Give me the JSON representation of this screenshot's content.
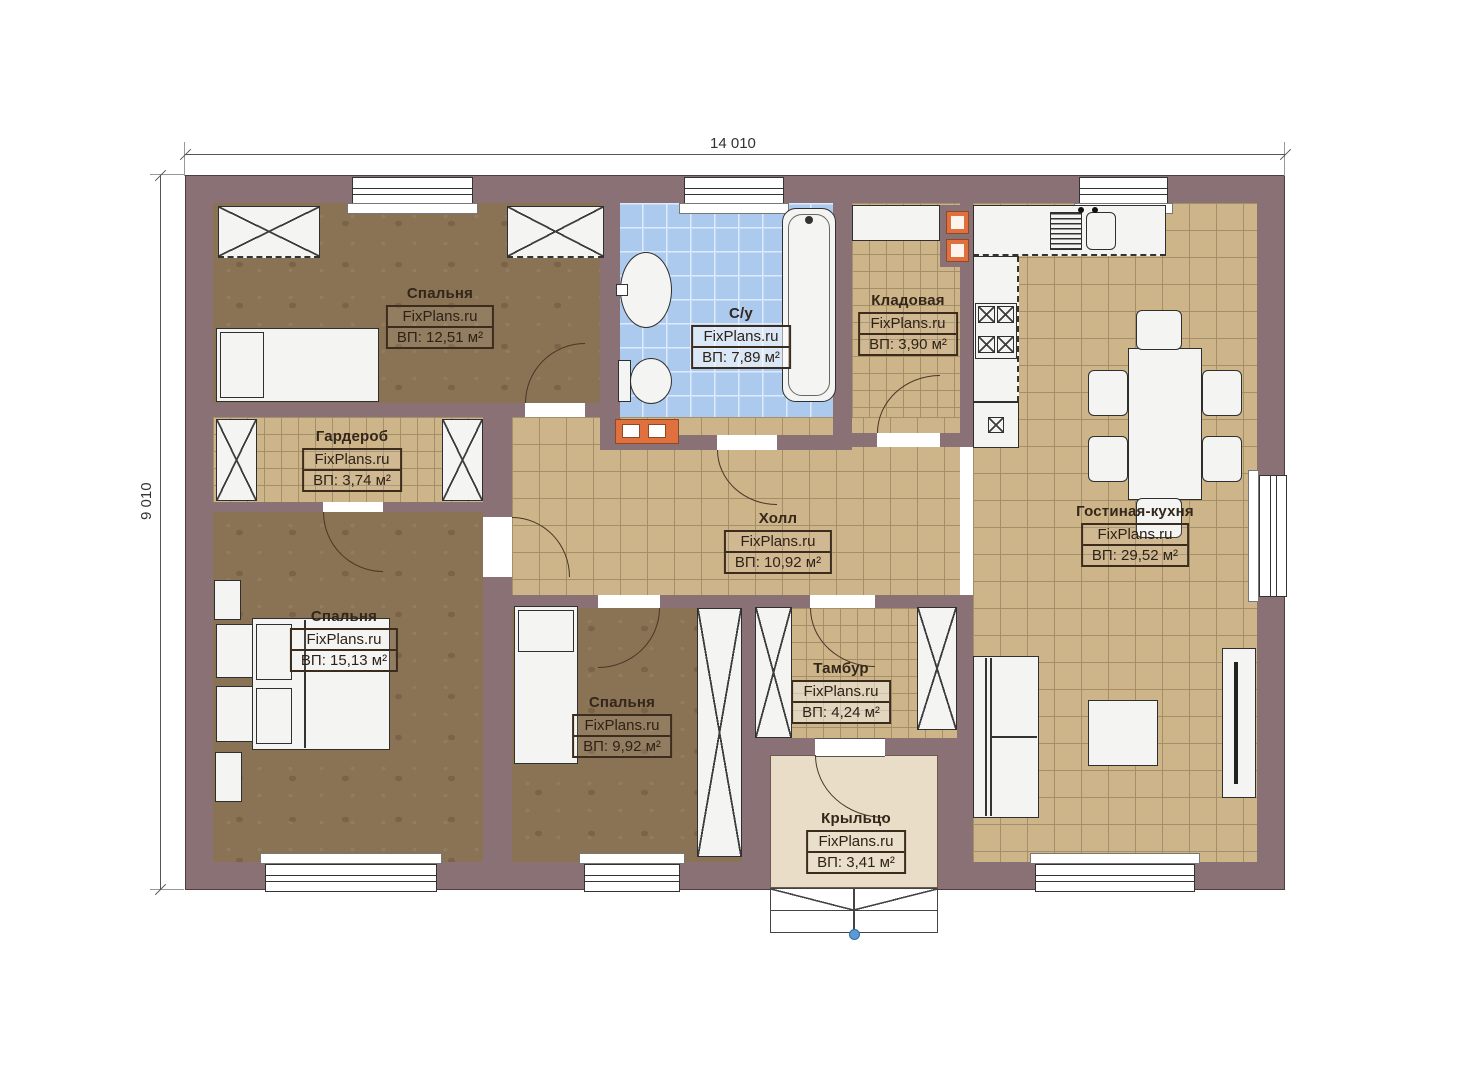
{
  "dimensions": {
    "width": "14 010",
    "height": "9 010"
  },
  "watermark": "FixPlans.ru",
  "rooms": [
    {
      "key": "bedroom-1",
      "name": "Спальня",
      "watermark": "FixPlans.ru",
      "area_label": "ВП: 12,51 м²"
    },
    {
      "key": "bathroom",
      "name": "С/у",
      "watermark": "FixPlans.ru",
      "area_label": "ВП: 7,89 м²"
    },
    {
      "key": "pantry",
      "name": "Кладовая",
      "watermark": "FixPlans.ru",
      "area_label": "ВП: 3,90 м²"
    },
    {
      "key": "wardrobe",
      "name": "Гардероб",
      "watermark": "FixPlans.ru",
      "area_label": "ВП: 3,74 м²"
    },
    {
      "key": "hall",
      "name": "Холл",
      "watermark": "FixPlans.ru",
      "area_label": "ВП: 10,92 м²"
    },
    {
      "key": "living-kitchen",
      "name": "Гостиная-кухня",
      "watermark": "FixPlans.ru",
      "area_label": "ВП: 29,52 м²"
    },
    {
      "key": "bedroom-2",
      "name": "Спальня",
      "watermark": "FixPlans.ru",
      "area_label": "ВП: 15,13 м²"
    },
    {
      "key": "bedroom-3",
      "name": "Спальня",
      "watermark": "FixPlans.ru",
      "area_label": "ВП: 9,92 м²"
    },
    {
      "key": "vestibule",
      "name": "Тамбур",
      "watermark": "FixPlans.ru",
      "area_label": "ВП: 4,24 м²"
    },
    {
      "key": "porch",
      "name": "Крыльцо",
      "watermark": "FixPlans.ru",
      "area_label": "ВП: 3,41 м²"
    }
  ],
  "colors": {
    "wall": "#8a7175",
    "floor_bedroom": "#8a7254",
    "floor_tile_tan": "#cdb489",
    "tile_grid": "#a3906b",
    "floor_bath": "#abcaee",
    "floor_porch": "#e9ddc7",
    "accent_orange": "#e0703d",
    "line_dark": "#3a2d22"
  }
}
